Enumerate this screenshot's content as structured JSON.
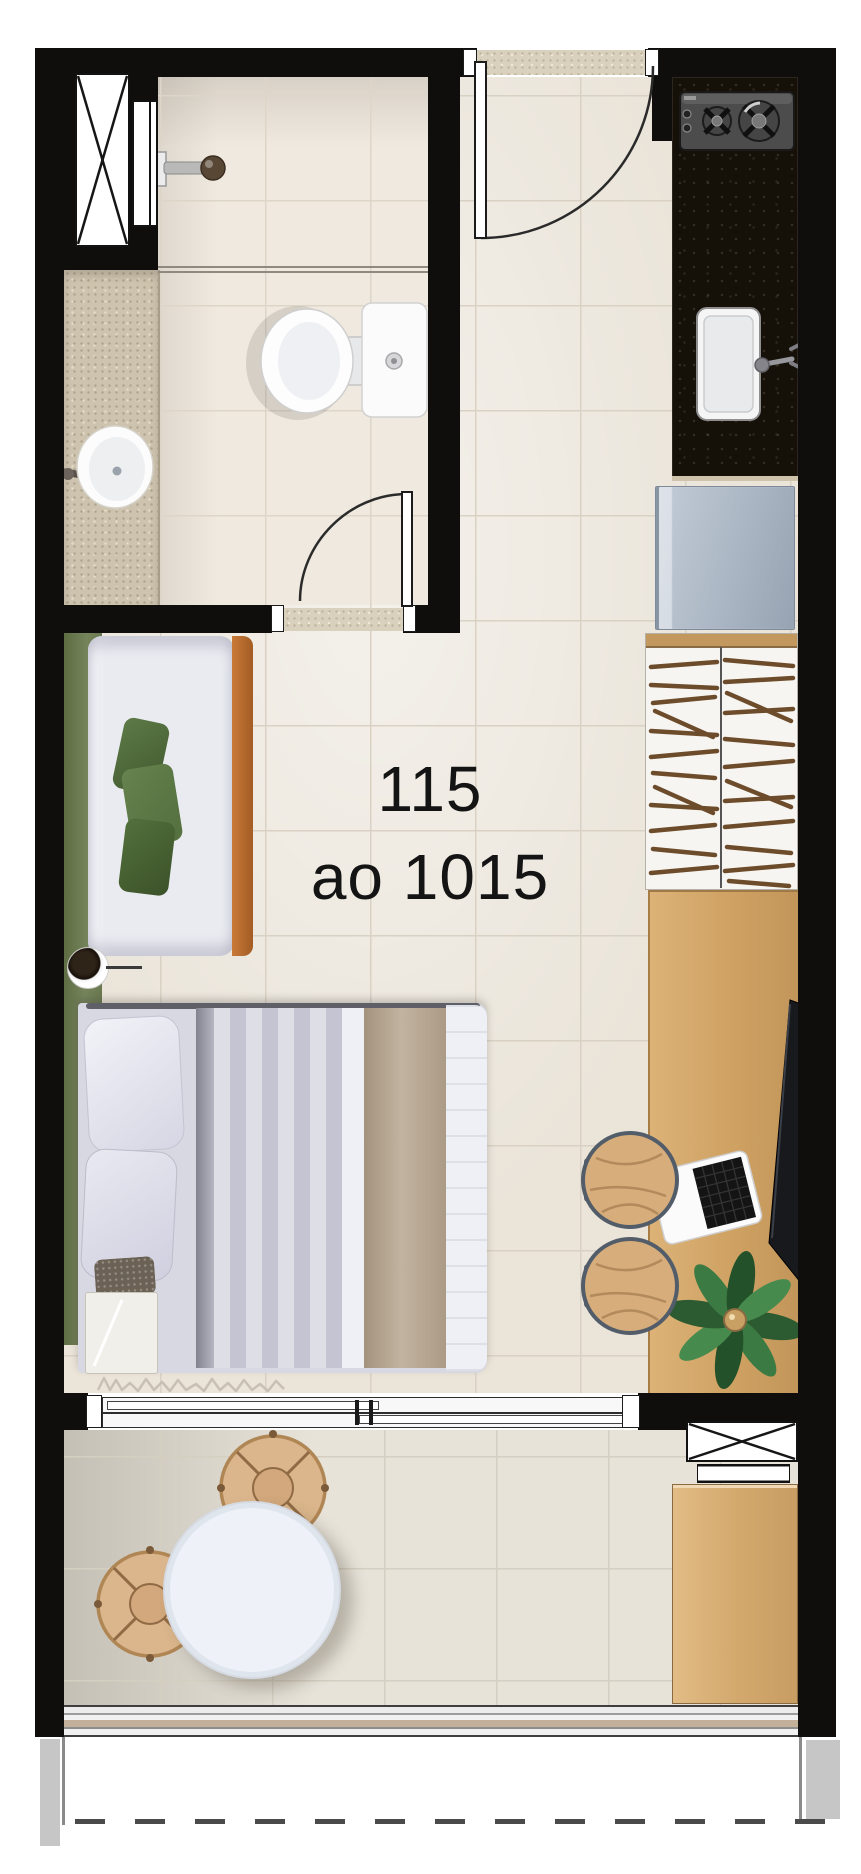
{
  "unit_label": {
    "line1": "115",
    "line2": "ao 1015"
  },
  "floorplan": {
    "type": "studio-apartment-top-view",
    "rooms": [
      {
        "name": "bathroom",
        "fixtures": [
          "ventilation-shaft",
          "shower-panel",
          "shower-head",
          "glass-partition",
          "toilet",
          "vanity-counter",
          "vanity-sink",
          "swing-door"
        ]
      },
      {
        "name": "entry",
        "fixtures": [
          "entrance-door",
          "door-sill"
        ]
      },
      {
        "name": "kitchen",
        "fixtures": [
          "granite-counter",
          "two-burner-cooktop",
          "kitchen-sink",
          "refrigerator"
        ]
      },
      {
        "name": "living-sleeping-area",
        "fixtures": [
          "sofa",
          "green-cushions",
          "floor-lamp",
          "green-rug-runner",
          "double-bed",
          "pillows",
          "nightstand",
          "rug-fringe",
          "wardrobe-with-hangers",
          "wood-desk",
          "tv-panel",
          "laptop",
          "desk-stool",
          "desk-stool",
          "potted-plant",
          "sliding-glass-door"
        ]
      },
      {
        "name": "balcony",
        "fixtures": [
          "round-table",
          "wicker-chair",
          "wicker-chair",
          "wood-cabinet",
          "fixed-window",
          "window-sill-vent",
          "railing"
        ]
      }
    ],
    "colors": {
      "wall": "#0f0e0c",
      "floor_tile": "#eae4d9",
      "tile_grout": "#d9d1c3",
      "bathroom_tile": "#efe9df",
      "granite_counter_light": "#cdc3af",
      "granite_counter_dark": "#151109",
      "sofa_wood": "#b06a32",
      "desk_wood": "#d3a569",
      "cabinet_wood": "#d7ae77",
      "rug_green": "#72815a",
      "cushion_green": "#55713f",
      "refrigerator": "#aab6c4",
      "bed_sheet": "#d8d8e2",
      "blanket_beige": "#b4a491",
      "chair_tan": "#d8b38a",
      "chair_trim": "#525d69",
      "table_white": "#eef1f7",
      "plant_green": "#35693a",
      "tv_dark": "#17191d",
      "label_text": "#141414"
    }
  }
}
